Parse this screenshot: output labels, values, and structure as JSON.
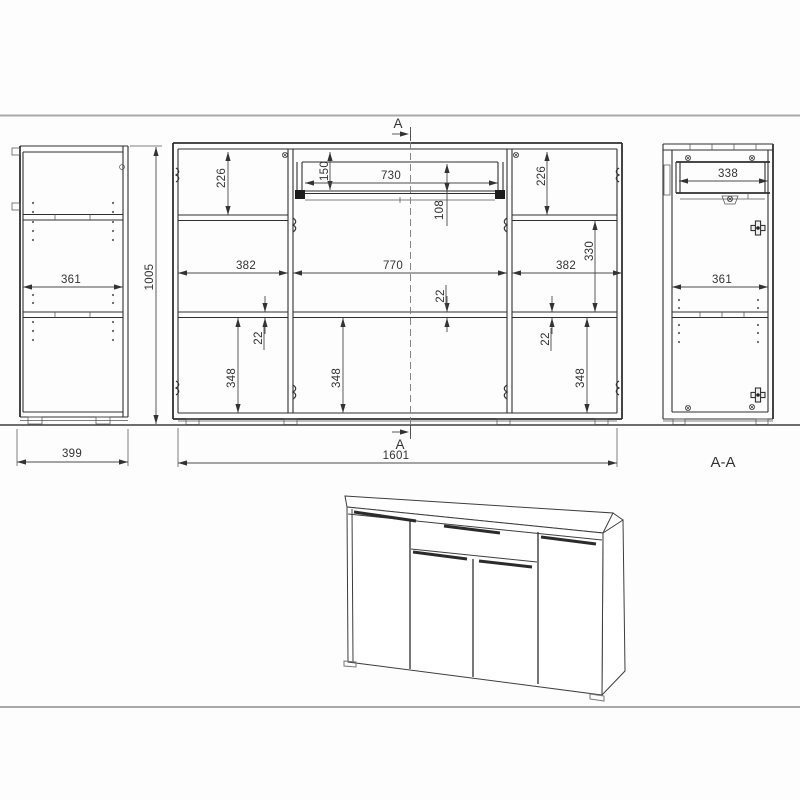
{
  "colors": {
    "structure_line": "#2f2f2f",
    "dimension_line": "#4a4a4a",
    "dimension_text": "#333333",
    "frame_line": "#a9a9a9",
    "ground_line": "#3f3f3f"
  },
  "left_side_view": {
    "inner_depth": "361",
    "total_depth": "399",
    "total_height": "1005"
  },
  "front_view": {
    "left_section_height": "226",
    "right_section_height": "226",
    "drawer_front_height": "150",
    "drawer_width": "730",
    "drawer_box_height": "108",
    "right_shelf_spacing": "330",
    "left_section_width": "382",
    "middle_section_width": "770",
    "right_section_width": "382",
    "shelf_thickness_left": "22",
    "shelf_thickness_center": "22",
    "shelf_thickness_right": "22",
    "left_door_height": "348",
    "middle_door_height": "348",
    "right_door_height": "348",
    "total_width": "1601"
  },
  "section_view": {
    "drawer_depth": "338",
    "inner_depth": "361",
    "label": "A-A"
  },
  "section_markers": {
    "top": "A",
    "bottom": "A"
  }
}
